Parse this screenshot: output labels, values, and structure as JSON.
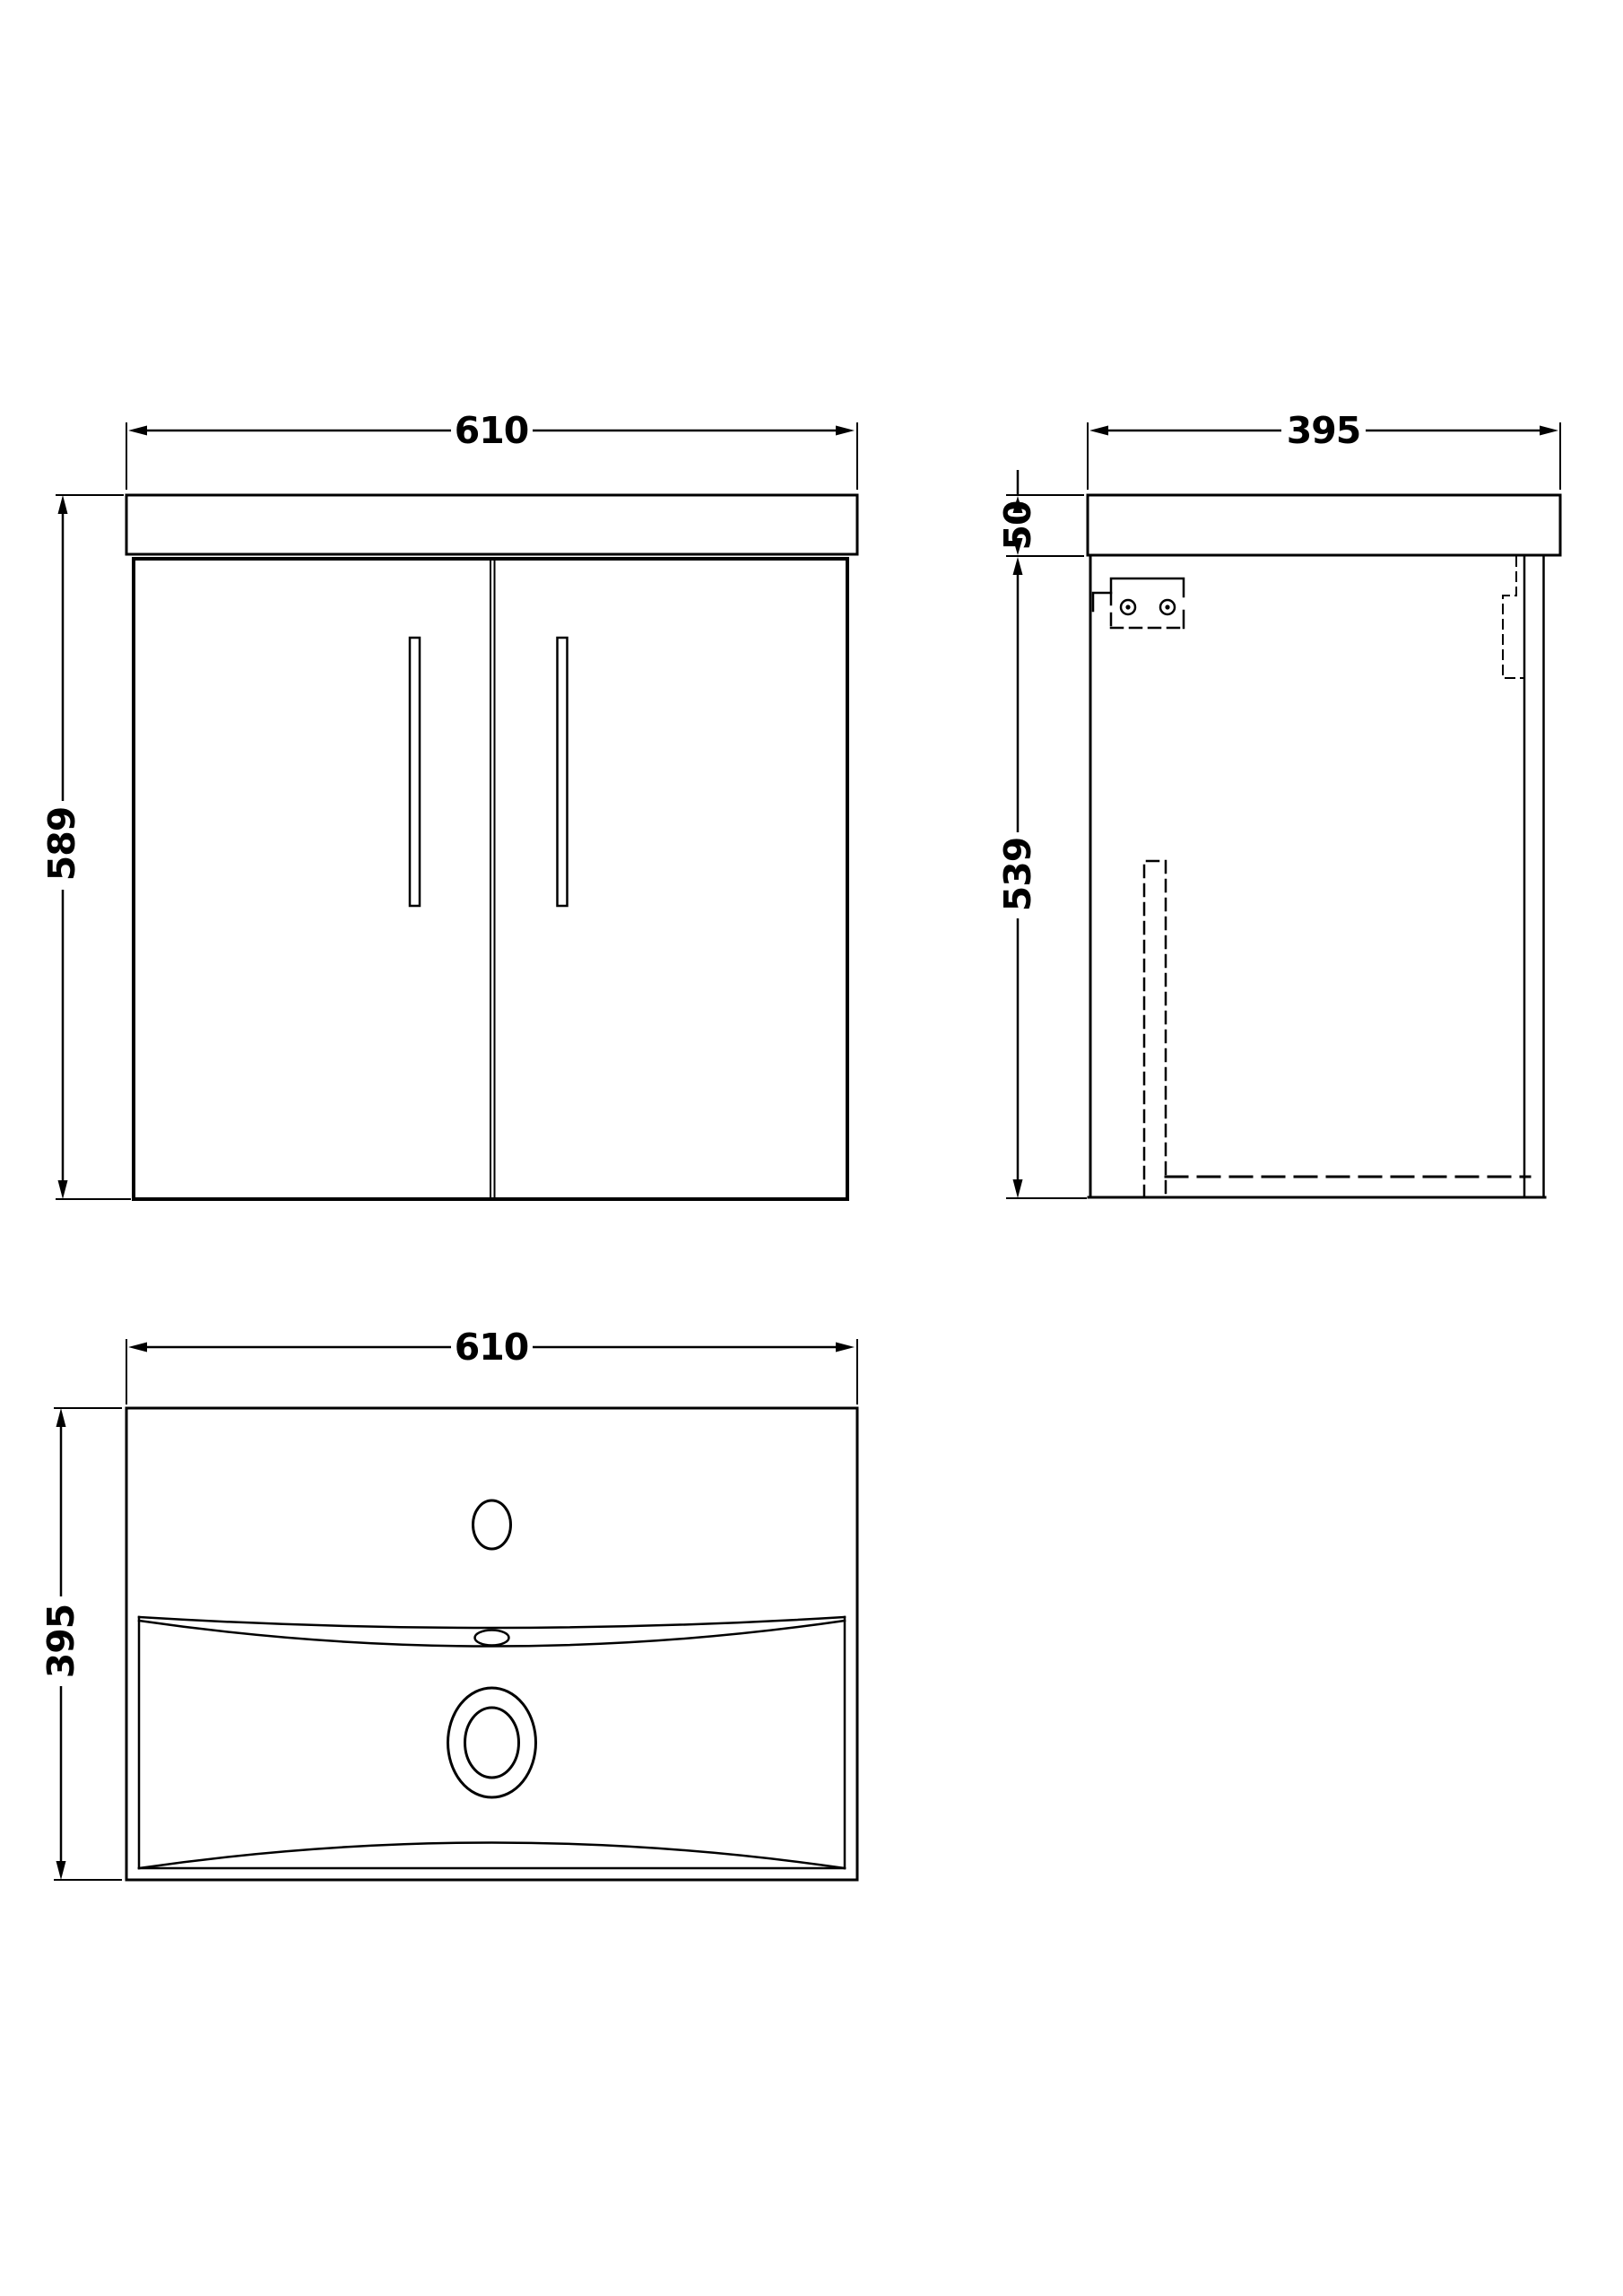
{
  "drawing": {
    "front_view": {
      "width_mm": "610",
      "height_mm": "589"
    },
    "side_view": {
      "depth_mm": "395",
      "worktop_thickness_mm": "50",
      "cabinet_height_mm": "539"
    },
    "basin_plan_view": {
      "width_mm": "610",
      "depth_mm": "395"
    }
  },
  "colors": {
    "line": "#000000",
    "background": "#ffffff"
  }
}
